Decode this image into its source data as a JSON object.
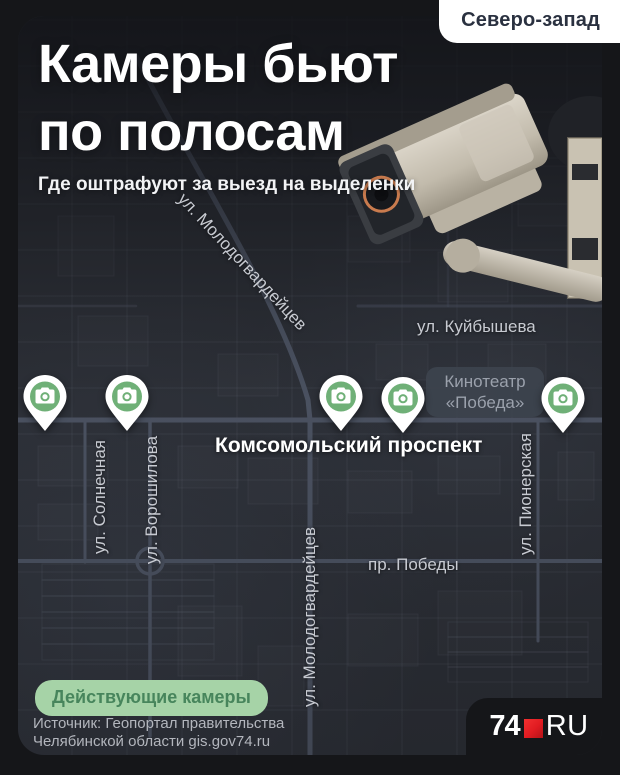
{
  "region_badge": "Северо-запад",
  "title": {
    "line1": "Камеры бьют",
    "line2": "по полосам",
    "subtitle": "Где оштрафуют за выезд на выделенки"
  },
  "map": {
    "streets": {
      "molodogvardeytsev_diagonal": "ул. Молодогвардейцев",
      "kuybysheva": "ул. Куйбышева",
      "komsomolsky_prospekt": "Комсомольский проспект",
      "solnechnaya": "ул. Солнечная",
      "voroshilova": "ул. Ворошилова",
      "molodogvardeytsev_vertical": "ул. Молодогвардейцев",
      "pobedy_prospekt": "пр. Победы",
      "pionerskaya": "ул. Пионерская"
    },
    "poi": {
      "cinema_line1": "Кинотеатр",
      "cinema_line2": "«Победа»"
    },
    "camera_pins_count": 5
  },
  "legend": {
    "active_cameras": "Действующие камеры"
  },
  "source": {
    "line1": "Источник: Геопортал правительства",
    "line2": "Челябинской области gis.gov74.ru"
  },
  "logo": {
    "prefix": "74",
    "suffix": "RU"
  },
  "colors": {
    "pin_green": "#6fb077",
    "legend_bg": "#a6d3a7",
    "legend_text": "#47855c",
    "logo_accent": "#e01b21",
    "map_base": "#2a2d34",
    "badge_text": "#2a3140"
  }
}
